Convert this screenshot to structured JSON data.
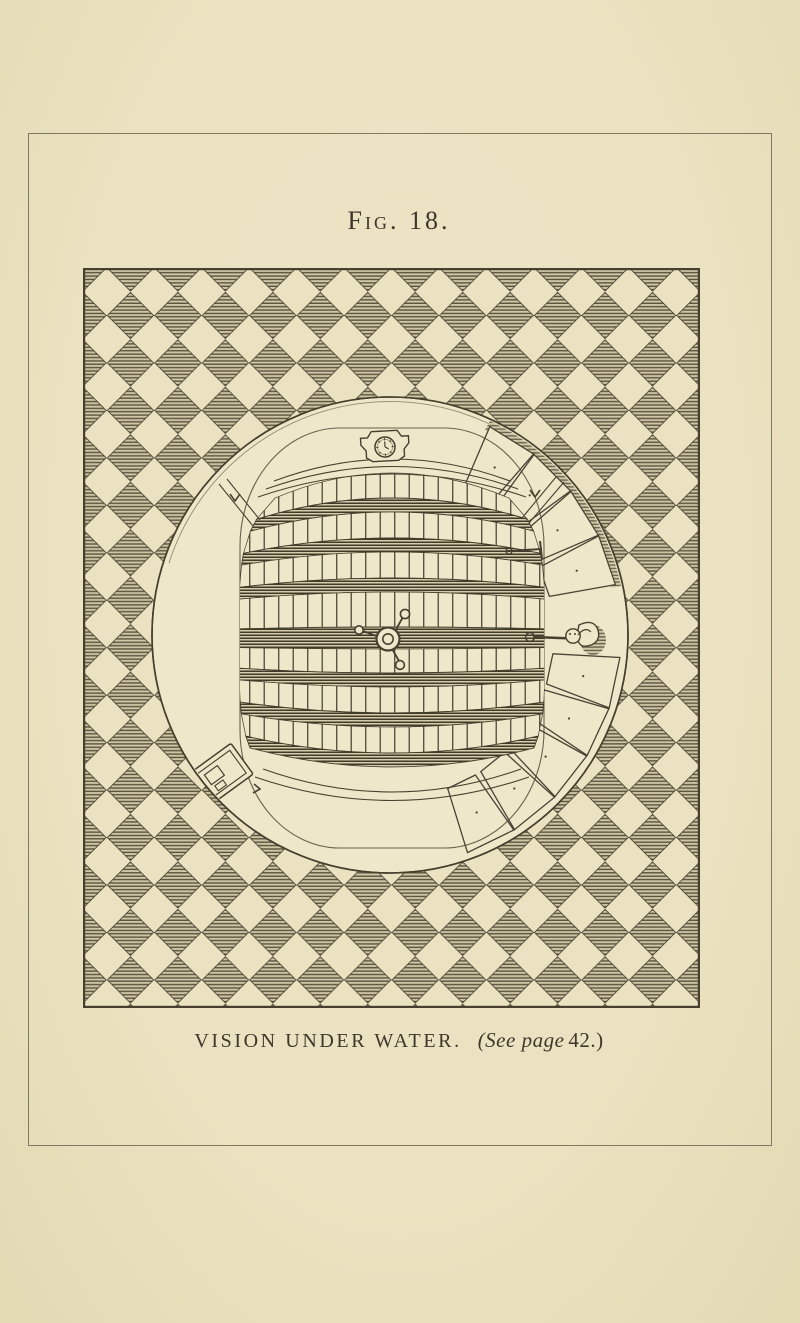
{
  "figure": {
    "label": "Fig. 18."
  },
  "caption": {
    "title": "VISION UNDER WATER.",
    "see_page": "(See page",
    "page_number": "42.)"
  },
  "colors": {
    "paper": "#ebe2c1",
    "paper-light": "#efe7c9",
    "ink": "#47402f",
    "frame-line": "#6e6651",
    "hatch-bg": "#cfc6a4",
    "hatch-line": "#564f3b",
    "beam-line": "#413b2b"
  }
}
